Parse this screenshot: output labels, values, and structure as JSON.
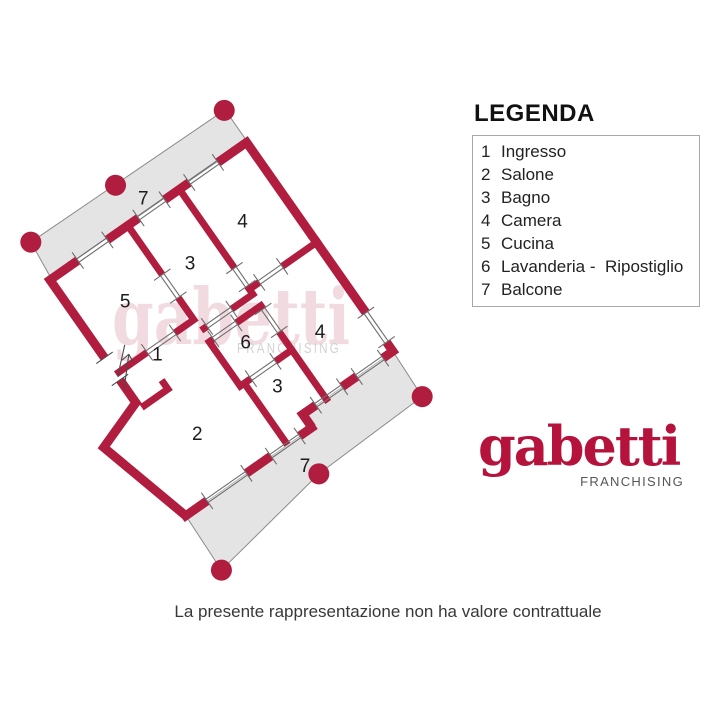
{
  "legend": {
    "title": "LEGENDA",
    "items": [
      {
        "num": "1",
        "label": "Ingresso"
      },
      {
        "num": "2",
        "label": "Salone"
      },
      {
        "num": "3",
        "label": "Bagno"
      },
      {
        "num": "4",
        "label": "Camera"
      },
      {
        "num": "5",
        "label": "Cucina"
      },
      {
        "num": "6",
        "label": "Lavanderia -  Ripostiglio"
      },
      {
        "num": "7",
        "label": "Balcone"
      }
    ]
  },
  "plan": {
    "room_labels": [
      {
        "room": "balcone-nord",
        "text": "7"
      },
      {
        "room": "cucina",
        "text": "5"
      },
      {
        "room": "bagno-1",
        "text": "3"
      },
      {
        "room": "camera-1",
        "text": "4"
      },
      {
        "room": "ingresso",
        "text": "1"
      },
      {
        "room": "lavanderia-ripostiglio",
        "text": "6"
      },
      {
        "room": "camera-2",
        "text": "4"
      },
      {
        "room": "bagno-2",
        "text": "3"
      },
      {
        "room": "salone",
        "text": "2"
      },
      {
        "room": "balcone-sud",
        "text": "7"
      }
    ]
  },
  "watermark": {
    "word": "gabetti",
    "sub": "FRANCHISING"
  },
  "logo": {
    "word": "gabetti",
    "sub": "FRANCHISING"
  },
  "disclaimer": "La presente rappresentazione non ha valore contrattuale",
  "colors": {
    "wall": "#B01D3E",
    "balcony_fill": "#E4E4E5",
    "balcony_stroke": "#8A8A8A",
    "logo_red": "#B5123C",
    "franchising_gray": "#55565A",
    "watermark_pink": "rgba(176,29,62,0.16)"
  }
}
